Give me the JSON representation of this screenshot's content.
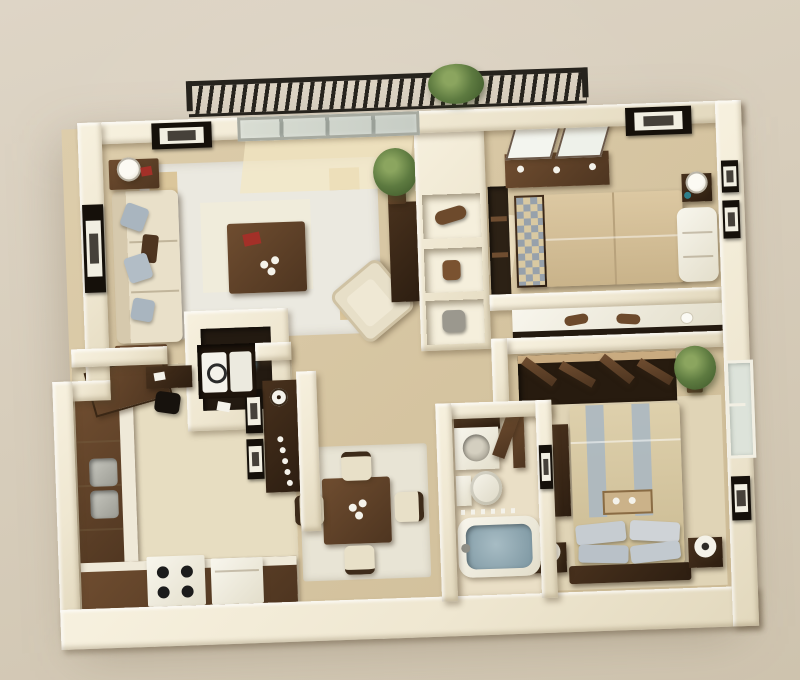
{
  "scene": {
    "kind": "3d-floor-plan-render",
    "view": "isometric-top-down",
    "unit": {
      "bedrooms": 2,
      "bathrooms": 1,
      "balcony": true
    }
  },
  "palette": {
    "bg": "#d7cdbb",
    "wall": "#f2ecd9",
    "floor": "#d8c7a5",
    "tile": "#e8dec3",
    "rug": "#ebe9e0",
    "accent": "#d8bf8e",
    "wood": "#5d4027",
    "wooddark": "#37261a",
    "sofa": "#e9e0c9",
    "pillow": "#a9b5bf",
    "bedtan": "#d6c29c",
    "water": "#8ba2ac",
    "plantgreen": "#56713c",
    "railing": "#26231d",
    "redaccent": "#a33028",
    "whiteobj": "#f4f2ea",
    "glass": "#d3d8cf"
  },
  "rooms": {
    "living": "Living Room",
    "dining": "Dining Area",
    "kitchen": "Kitchen",
    "bedroom1": "Bedroom 1",
    "bedroom2": "Bedroom 2",
    "bathroom": "Bathroom",
    "hallway": "Hallway",
    "balcony": "Balcony",
    "laundry": "Laundry Closet"
  },
  "furniture": {
    "balcony": [
      "railing",
      "potted-plant"
    ],
    "living": [
      "sofa",
      "throw-pillows",
      "end-tables",
      "table-lamps",
      "coffee-table",
      "red-book",
      "area-rug",
      "armchair",
      "tv-niche",
      "console-with-clock",
      "leaning-frames",
      "wall-art",
      "sliding-glass-door",
      "tall-plant",
      "side-console"
    ],
    "dining": [
      "square-table",
      "four-chairs",
      "centerpiece-bowls",
      "area-rug"
    ],
    "kitchen": [
      "l-shaped-counter",
      "double-sink",
      "range",
      "dishwasher",
      "open-door",
      "desk",
      "desk-chair"
    ],
    "laundry": [
      "washer",
      "dryer"
    ],
    "hallway": [
      "shelf-niches",
      "duffel",
      "basket",
      "storage-bin",
      "vanity-counter",
      "trays"
    ],
    "bedroom1": [
      "double-bed",
      "checkered-runner",
      "dresser-with-mirrors",
      "nightstand",
      "table-lamp",
      "chaise",
      "wall-art",
      "closet-shelves"
    ],
    "bedroom2": [
      "double-bed",
      "striped-duvet",
      "breakfast-tray",
      "pillows",
      "two-nightstands",
      "two-lamps",
      "open-closet",
      "bifold-doors",
      "window",
      "potted-plant",
      "tall-chest",
      "wall-art"
    ],
    "bathroom": [
      "vanity-sink",
      "toilet",
      "bathtub",
      "wall-art",
      "door"
    ]
  }
}
